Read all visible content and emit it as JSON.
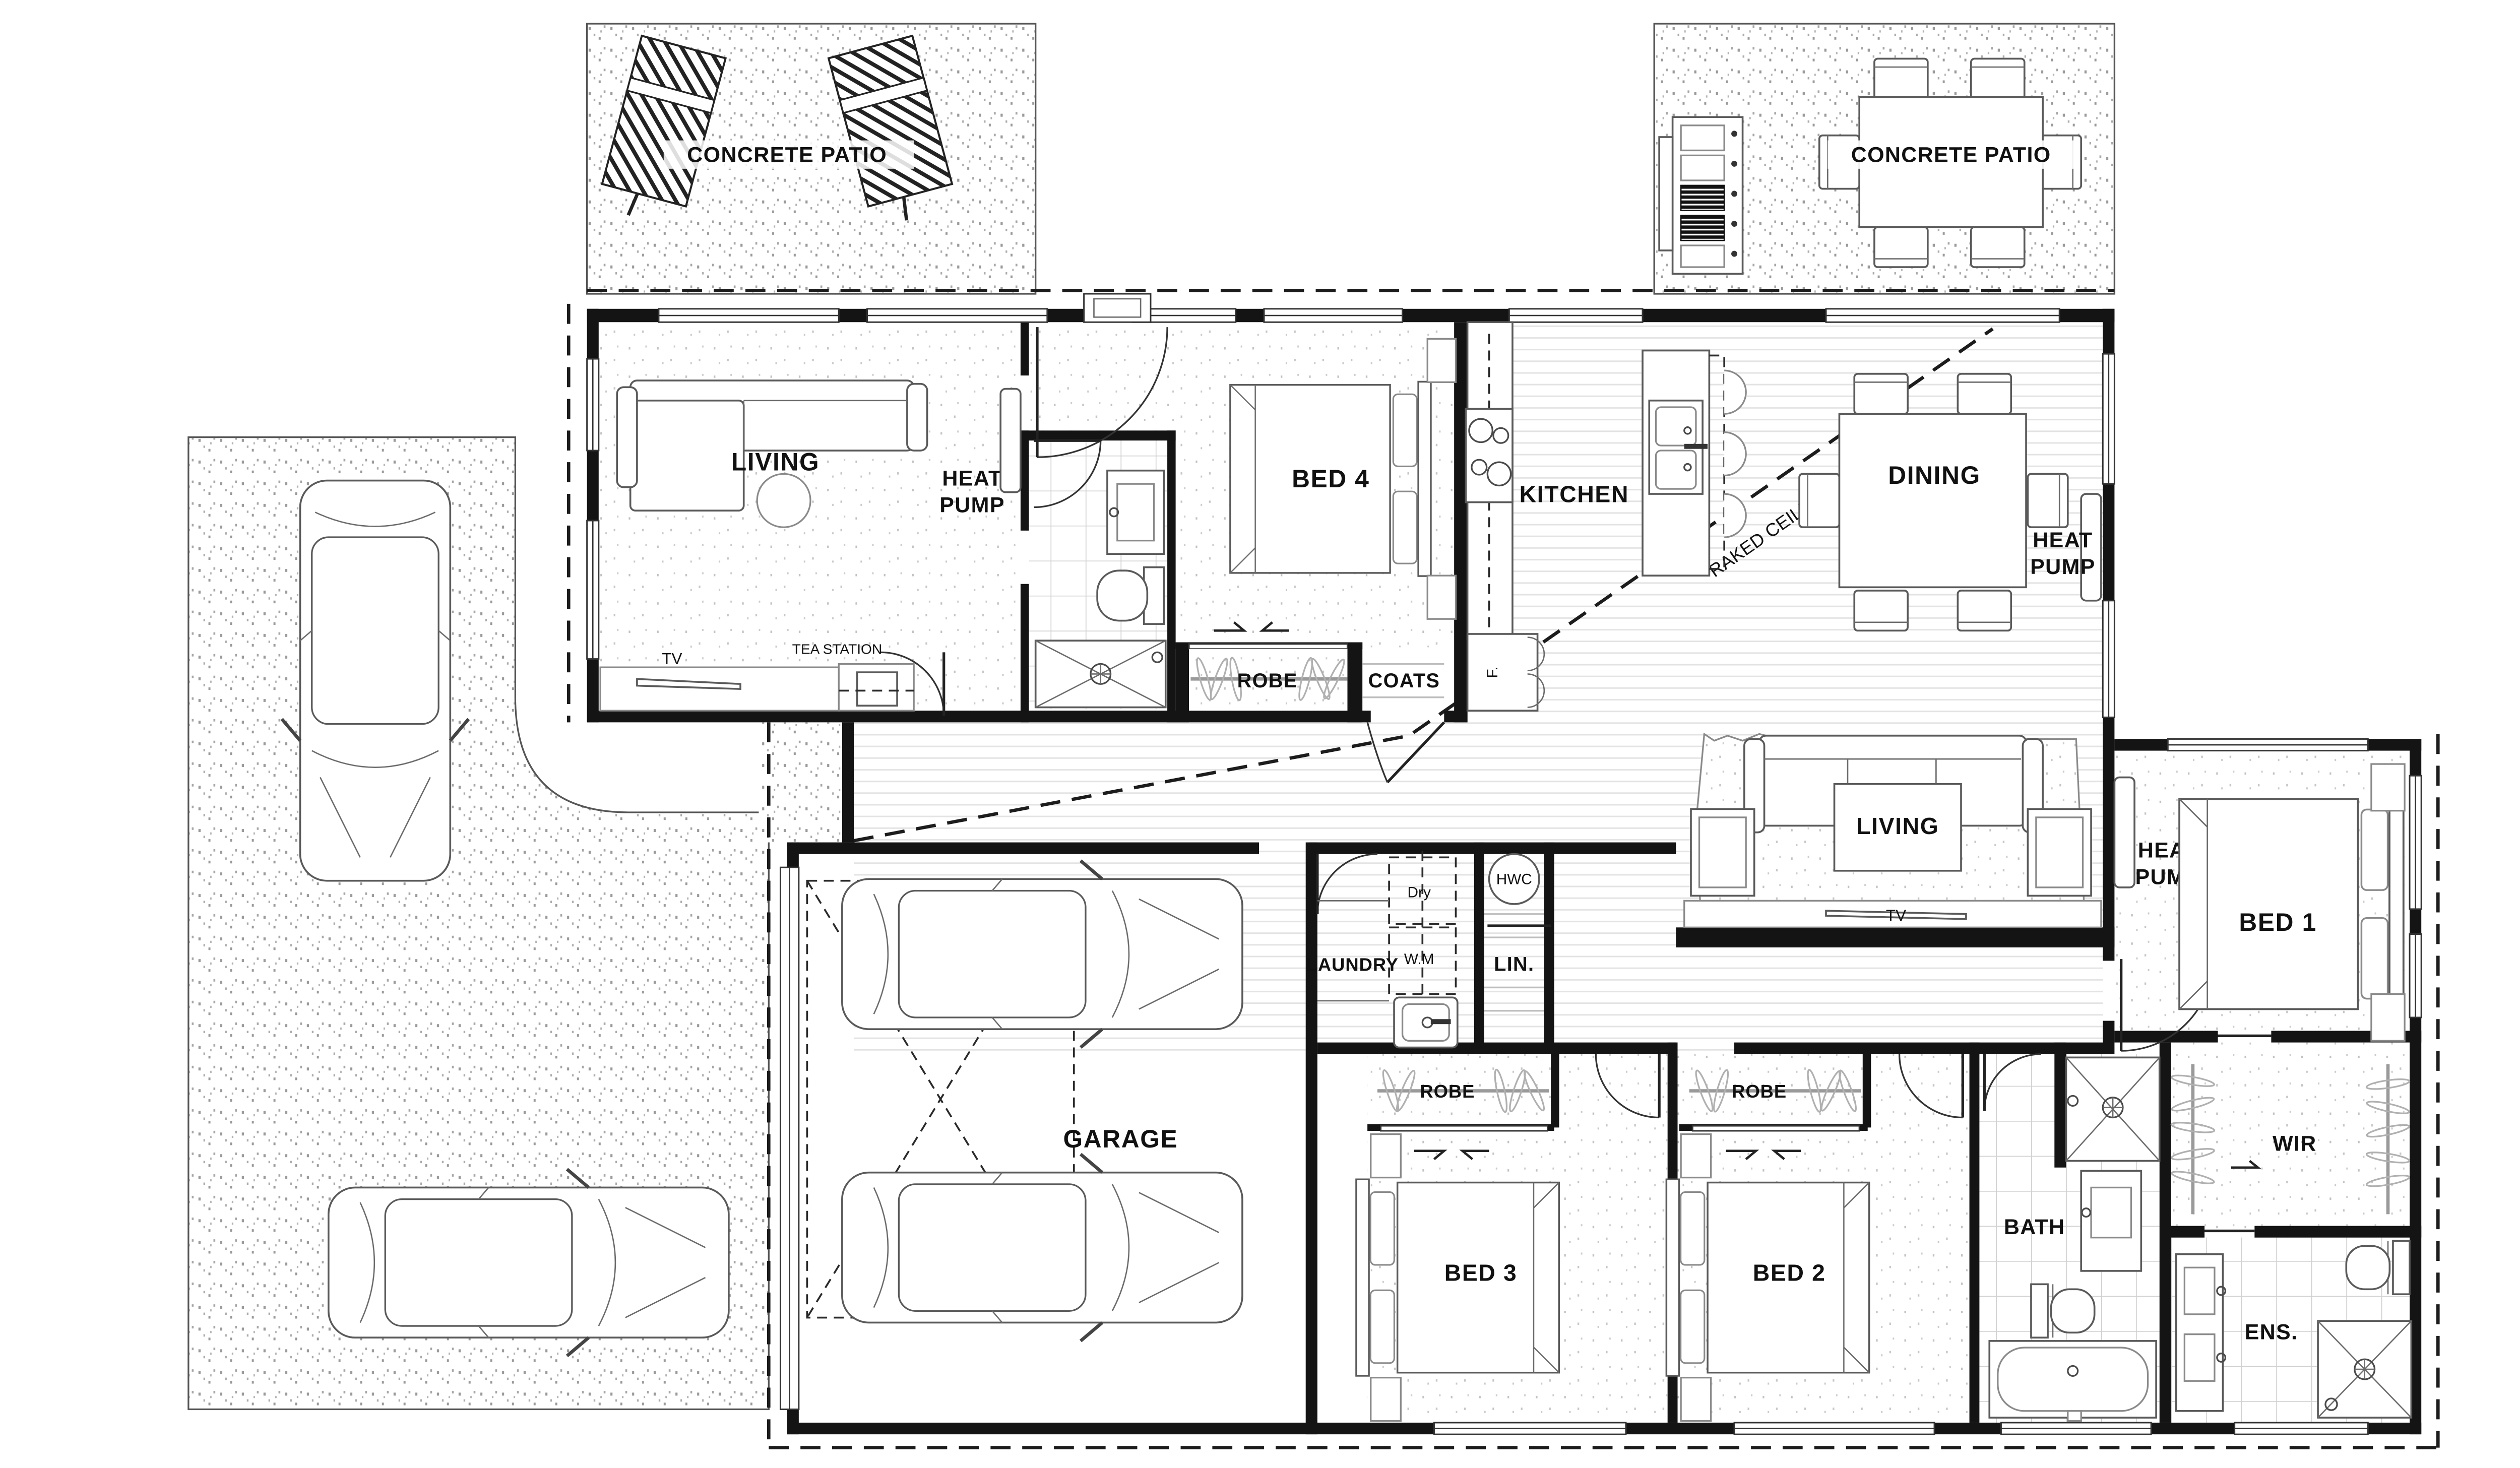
{
  "title": "Four bedroom house floor plan",
  "labels": {
    "patio_nw": "CONCRETE PATIO",
    "patio_ne": "CONCRETE PATIO",
    "living_west": "LIVING",
    "heat_word": "HEAT",
    "pump_word": "PUMP",
    "tea_station": "TEA STATION",
    "tv_west": "TV",
    "bed4": "BED 4",
    "robe_bed4": "ROBE",
    "coats": "COATS",
    "kitchen": "KITCHEN",
    "fridge": "F.",
    "dining": "DINING",
    "raked_ceiling": "RAKED CEILING",
    "living_family": "LIVING",
    "tv_family": "TV",
    "bed1": "BED 1",
    "laundry": "LAUNDRY",
    "dryer": "Dry",
    "washing_machine": "W.M",
    "hwc": "HWC",
    "linen": "LIN.",
    "garage": "GARAGE",
    "bed3": "BED 3",
    "bed2": "BED 2",
    "robe_bed3": "ROBE",
    "robe_bed2": "ROBE",
    "bath": "BATH",
    "wir": "WIR",
    "ens": "ENS."
  },
  "colors": {
    "wall": "#141414",
    "text": "#111111",
    "concrete_dots": "#9a9a9a",
    "carpet_dots": "#c2c2c2",
    "wood_line": "#e3e3e3",
    "tile_line": "#d0d0d0"
  }
}
